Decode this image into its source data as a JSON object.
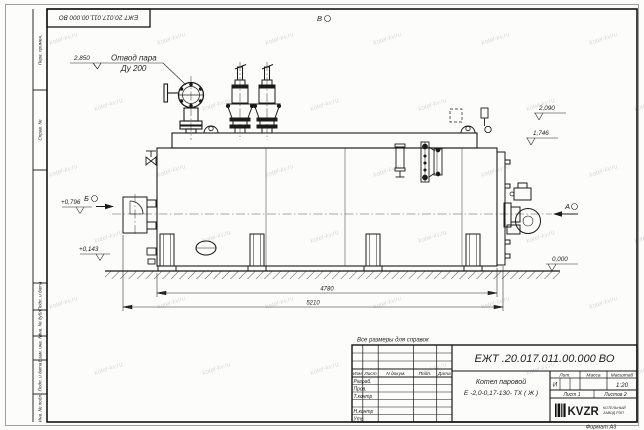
{
  "sheet": {
    "stamp_doc_number": "ЕЖТ 20.017.011.00.000  ВО",
    "format_label": "Формат А3",
    "reference_note": "Все размеры для справок",
    "view_top": "В",
    "watermark": "kotel-kv.ru"
  },
  "border_labels": {
    "perv_primen": "Перв. примен.",
    "sprav_no": "Справ. №",
    "podp_data_1": "Подп. и дата",
    "inv_dubl": "Инв. № дубл.",
    "vzam_inv": "Взам. инв. №",
    "podp_data_2": "Подп. и дата",
    "inv_podl": "Инв. № подл."
  },
  "annotations": {
    "steam_outlet_line1": "Отвод пара",
    "steam_outlet_line2": "Ду 200",
    "view_a": "А",
    "view_b": "Б"
  },
  "dimensions": {
    "elev_2850": "2,850",
    "elev_2090": "2,090",
    "elev_1746": "1,746",
    "elev_0796": "+0,796",
    "elev_0143": "+0,143",
    "elev_0000": "0,000",
    "length_inner": "4780",
    "length_outer": "5210"
  },
  "title_block": {
    "doc_number": "ЕЖТ .20.017.011.00.000  ВО",
    "name_line1": "Котел паровой",
    "name_line2": "Е -2,0-0,17-130- ТХ ( Ж )",
    "col_izm": "Изм",
    "col_list": "Лист",
    "col_ndoc": "N докум.",
    "col_podp": "Подп.",
    "col_data": "Дата",
    "row_razrab": "Разраб.",
    "row_prov": "Пров.",
    "row_tkontr": "Т.контр",
    "row_nkontr": "Н.контр",
    "row_utv": "Утв.",
    "lit_label": "Лит.",
    "mass_label": "Масса",
    "scale_label": "Масштаб",
    "lit_value": "И",
    "scale_value": "1:20",
    "sheet_no": "Лист 1",
    "sheets_total": "Листов  2",
    "logo_text": "KVZR",
    "company_line1": "КОТЕЛЬНЫЙ",
    "company_line2": "ЗАВОД РЭП"
  }
}
